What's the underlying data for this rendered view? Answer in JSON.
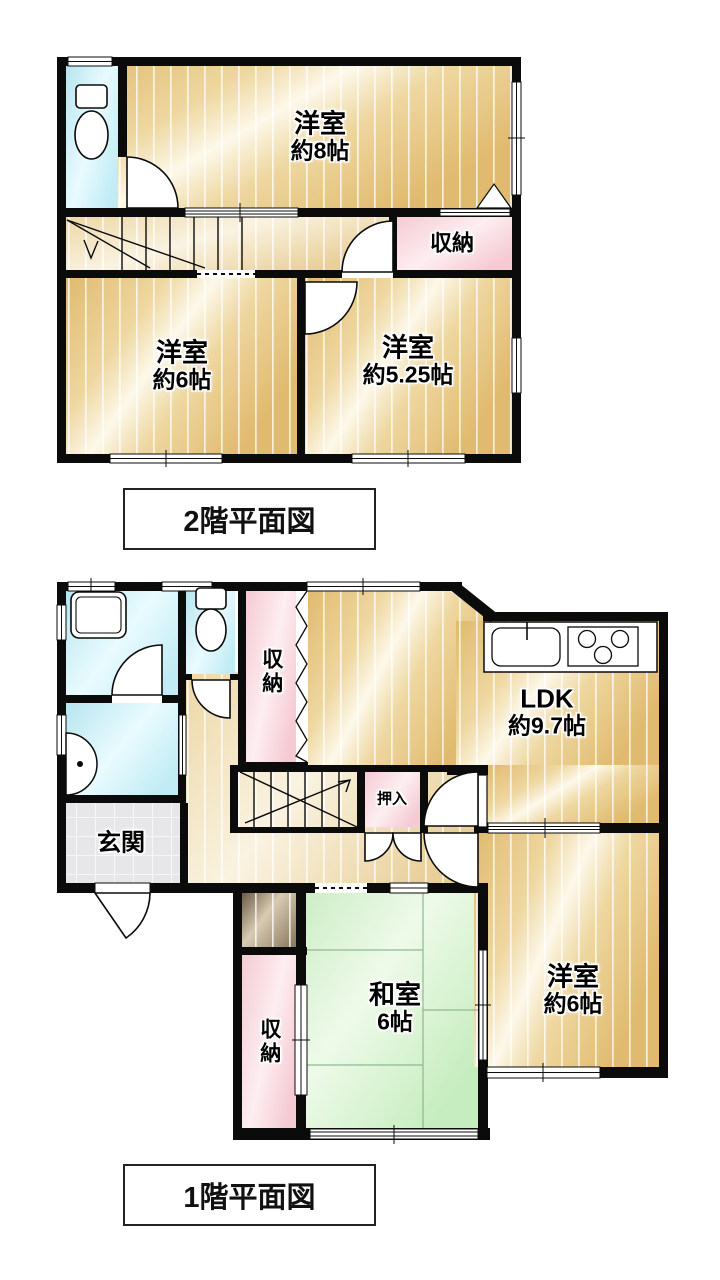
{
  "floor2": {
    "caption": "2階平面図",
    "western8": {
      "name": "洋室",
      "size": "約8帖"
    },
    "closet": {
      "name": "収納"
    },
    "western6": {
      "name": "洋室",
      "size": "約6帖"
    },
    "western525": {
      "name": "洋室",
      "size": "約5.25帖"
    }
  },
  "floor1": {
    "caption": "1階平面図",
    "closet_top": {
      "name": "収納"
    },
    "ldk": {
      "name": "LDK",
      "size": "約9.7帖"
    },
    "oshiire": {
      "name": "押入"
    },
    "genkan": {
      "name": "玄関"
    },
    "washitsu": {
      "name": "和室",
      "size": "6帖"
    },
    "western6": {
      "name": "洋室",
      "size": "約6帖"
    },
    "closet_bottom": {
      "name": "収納"
    }
  },
  "colors": {
    "wall": "#0b0b0b",
    "wood_floor": "#eed7a0",
    "water_rooms": "#c2ecf5",
    "closet_pink": "#f5cad3",
    "tatami_green": "#c6edbf",
    "entrance_gray": "#e7e6e9"
  }
}
